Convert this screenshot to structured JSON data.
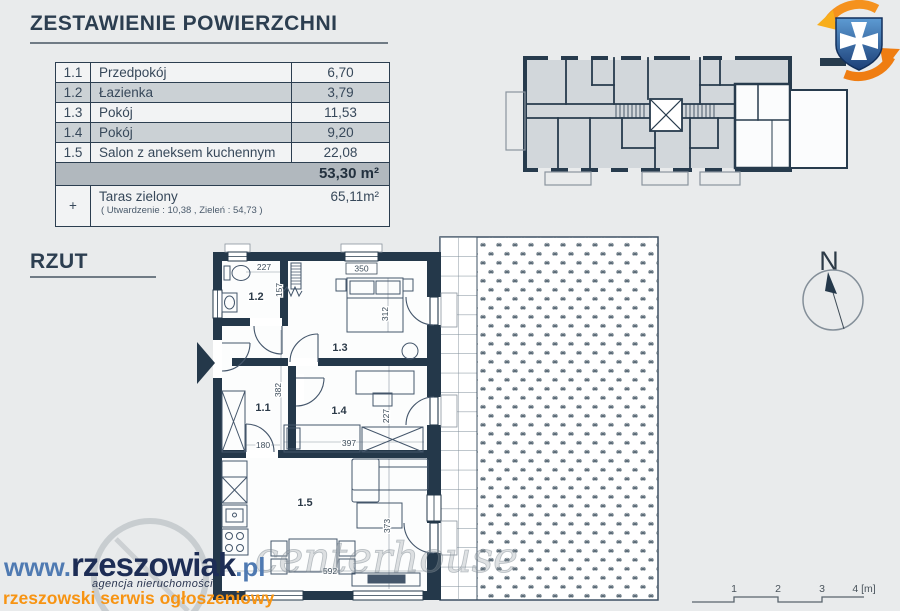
{
  "header": {
    "title": "ZESTAWIENIE POWIERZCHNI"
  },
  "area_table": {
    "rows": [
      {
        "no": "1.1",
        "name": "Przedpokój",
        "area": "6,70"
      },
      {
        "no": "1.2",
        "name": "Łazienka",
        "area": "3,79"
      },
      {
        "no": "1.3",
        "name": "Pokój",
        "area": "11,53"
      },
      {
        "no": "1.4",
        "name": "Pokój",
        "area": "9,20"
      },
      {
        "no": "1.5",
        "name": "Salon z aneksem kuchennym",
        "area": "22,08"
      }
    ],
    "total_area": "53,30 m²",
    "terrace_row": {
      "plus": "+",
      "name": "Taras zielony",
      "area": "65,11m²",
      "note": "( Utwardzenie : 10,38 ,  Zieleń : 54,73 )"
    }
  },
  "plan_section": {
    "label": "RZUT"
  },
  "floor_plan": {
    "room_labels": {
      "hall": "1.1",
      "bath": "1.2",
      "bedroom1": "1.3",
      "bedroom2": "1.4",
      "living": "1.5"
    },
    "dimensions": {
      "bath_w": "227",
      "bath_h": "157",
      "bed1_w": "350",
      "bed1_h": "312",
      "hall_h": "382",
      "hall_door_w": "180",
      "bed2_w": "397",
      "bed2_h": "227",
      "living_h": "373",
      "living_w": "592"
    }
  },
  "compass": {
    "north": "N"
  },
  "scale_bar": {
    "t1": "1",
    "t2": "2",
    "t3": "3",
    "t4": "4 [m]"
  },
  "watermark": {
    "www": "www.",
    "brand": "rzeszowiak",
    "tld": ".pl",
    "subtitle": "agencja nieruchomości",
    "tagline": "rzeszowski serwis ogłoszeniowy",
    "ghost": "centerhouse"
  },
  "colors": {
    "wall": "#24384a",
    "navy_text": "#2c3e50",
    "orange": "#f79413",
    "brand_navy": "#1d2d55",
    "brand_blue": "#4f7ab2",
    "background": "#e9ebec"
  }
}
